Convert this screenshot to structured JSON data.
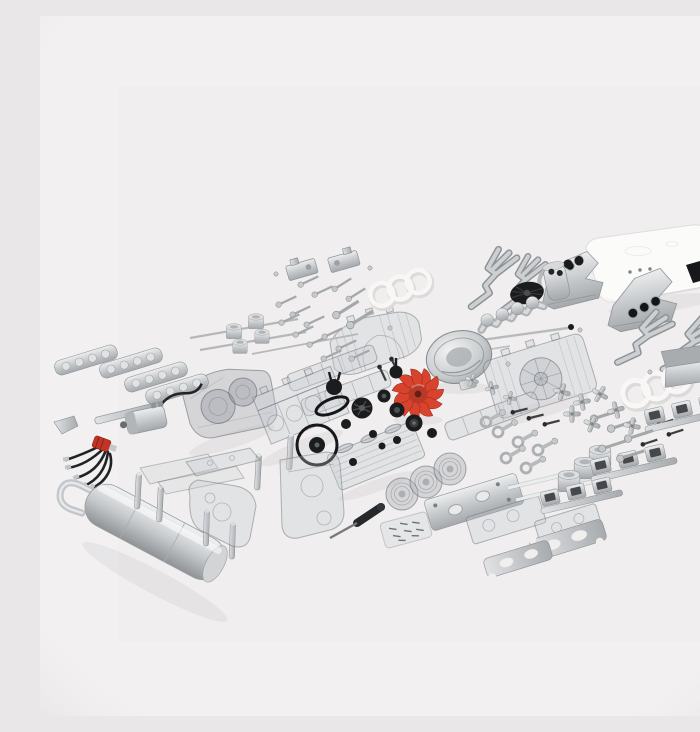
{
  "scene": {
    "type": "product-photo",
    "description": "Disassembled transparent flat-six boxer engine model kit: dozens of clear plastic, silver metal and black parts laid out flat on a white studio background with a red cooling fan in the center, a white engine cover at top right and a silver muffler at bottom left",
    "background": "#f2f0f1",
    "photo_background": "#f0eeee"
  },
  "palette": {
    "silver": "#c9ccce",
    "silver_light": "#eceeef",
    "silver_dark": "#9da1a5",
    "clear_part_fill": "rgba(197,202,208,0.30)",
    "clear_part_edge": "rgba(109,115,122,0.50)",
    "red": "#d8432e",
    "red_boot": "#c13526",
    "black": "#1b1c1e",
    "white_part": "#fbfbfa",
    "gasket_white": "#f8f7f5"
  },
  "parts": [
    {
      "id": "engine-cover",
      "label": "White engine cover shell with black vent window"
    },
    {
      "id": "heat-exchanger-left",
      "label": "Silver heat exchanger with black ports"
    },
    {
      "id": "heat-exchanger-right",
      "label": "Silver heat exchanger with three black ports"
    },
    {
      "id": "intake-boots",
      "label": "Black intake boots"
    },
    {
      "id": "exhaust-header-1",
      "label": "Three-branch exhaust header pipe"
    },
    {
      "id": "exhaust-header-2",
      "label": "Three-branch exhaust header pipe"
    },
    {
      "id": "exhaust-header-3",
      "label": "Three-branch exhaust header pipe"
    },
    {
      "id": "exhaust-header-4",
      "label": "Three-branch exhaust header pipe"
    },
    {
      "id": "oil-canister",
      "label": "Oil filler canister with hose"
    },
    {
      "id": "air-cleaner-cone",
      "label": "Black fan pulley cone"
    },
    {
      "id": "crankshaft",
      "label": "Silver crankshaft"
    },
    {
      "id": "camshaft-rod",
      "label": "Long camshaft rod"
    },
    {
      "id": "fan-housing",
      "label": "Polished alternator fan housing dish"
    },
    {
      "id": "cooling-fan",
      "label": "Red cooling fan impeller"
    },
    {
      "id": "fan-shroud-left",
      "label": "Clear fan shroud half"
    },
    {
      "id": "fan-shroud-right",
      "label": "Clear fan shroud half with hub"
    },
    {
      "id": "valve-trays",
      "label": "Clear valve cover trays"
    },
    {
      "id": "crankcase-left",
      "label": "Clear crankcase half with cylinder bores"
    },
    {
      "id": "crankcase-right",
      "label": "Clear crankcase block"
    },
    {
      "id": "cylinder-head",
      "label": "Clear finned cylinder head"
    },
    {
      "id": "cylinder-barrels",
      "label": "Clear finned cylinder barrels"
    },
    {
      "id": "timing-covers",
      "label": "Clear timing cover plates"
    },
    {
      "id": "clear-panels",
      "label": "Thin clear chassis panels"
    },
    {
      "id": "rocker-covers",
      "label": "Silver ribbed rocker covers"
    },
    {
      "id": "pushrods",
      "label": "Thin steel push rods"
    },
    {
      "id": "pistons-small",
      "label": "Small silver pistons"
    },
    {
      "id": "mounting-brackets",
      "label": "Silver mounting brackets"
    },
    {
      "id": "screws-top",
      "label": "Machine screws and bolts"
    },
    {
      "id": "screws-right",
      "label": "Long assembly bolts"
    },
    {
      "id": "screws-dark",
      "label": "Black set screws"
    },
    {
      "id": "head-gasket-top",
      "label": "White triple-ring head gasket"
    },
    {
      "id": "head-gasket-right",
      "label": "White triple-ring head gasket"
    },
    {
      "id": "oil-cooler",
      "label": "Silver oil cooler box"
    },
    {
      "id": "rocker-arms",
      "label": "Cross-shaped rocker arms"
    },
    {
      "id": "intake-runners",
      "label": "Intake runner assemblies"
    },
    {
      "id": "connecting-rods",
      "label": "Connecting rods"
    },
    {
      "id": "pistons-large",
      "label": "Large silver pistons"
    },
    {
      "id": "clear-tubes",
      "label": "Clear rod tubes"
    },
    {
      "id": "heat-shield",
      "label": "Perforated heat shield plate"
    },
    {
      "id": "base-plates",
      "label": "Clear base plates"
    },
    {
      "id": "flange-plates",
      "label": "Stamped exhaust flange plates"
    },
    {
      "id": "screwdriver",
      "label": "Black screwdriver tool"
    },
    {
      "id": "screw-bag",
      "label": "Bag of spare screws"
    },
    {
      "id": "motor",
      "label": "Electric drive motor with wire"
    },
    {
      "id": "ignition-wires",
      "label": "Ignition wire set with red boot"
    },
    {
      "id": "pulleys",
      "label": "Black pulleys and grommets"
    },
    {
      "id": "drive-belt",
      "label": "Black drive belt"
    },
    {
      "id": "o-ring",
      "label": "Large black O-ring with pulley"
    },
    {
      "id": "standoff-posts",
      "label": "Silver standoff posts"
    },
    {
      "id": "muffler",
      "label": "Silver muffler with tailpipe"
    }
  ]
}
